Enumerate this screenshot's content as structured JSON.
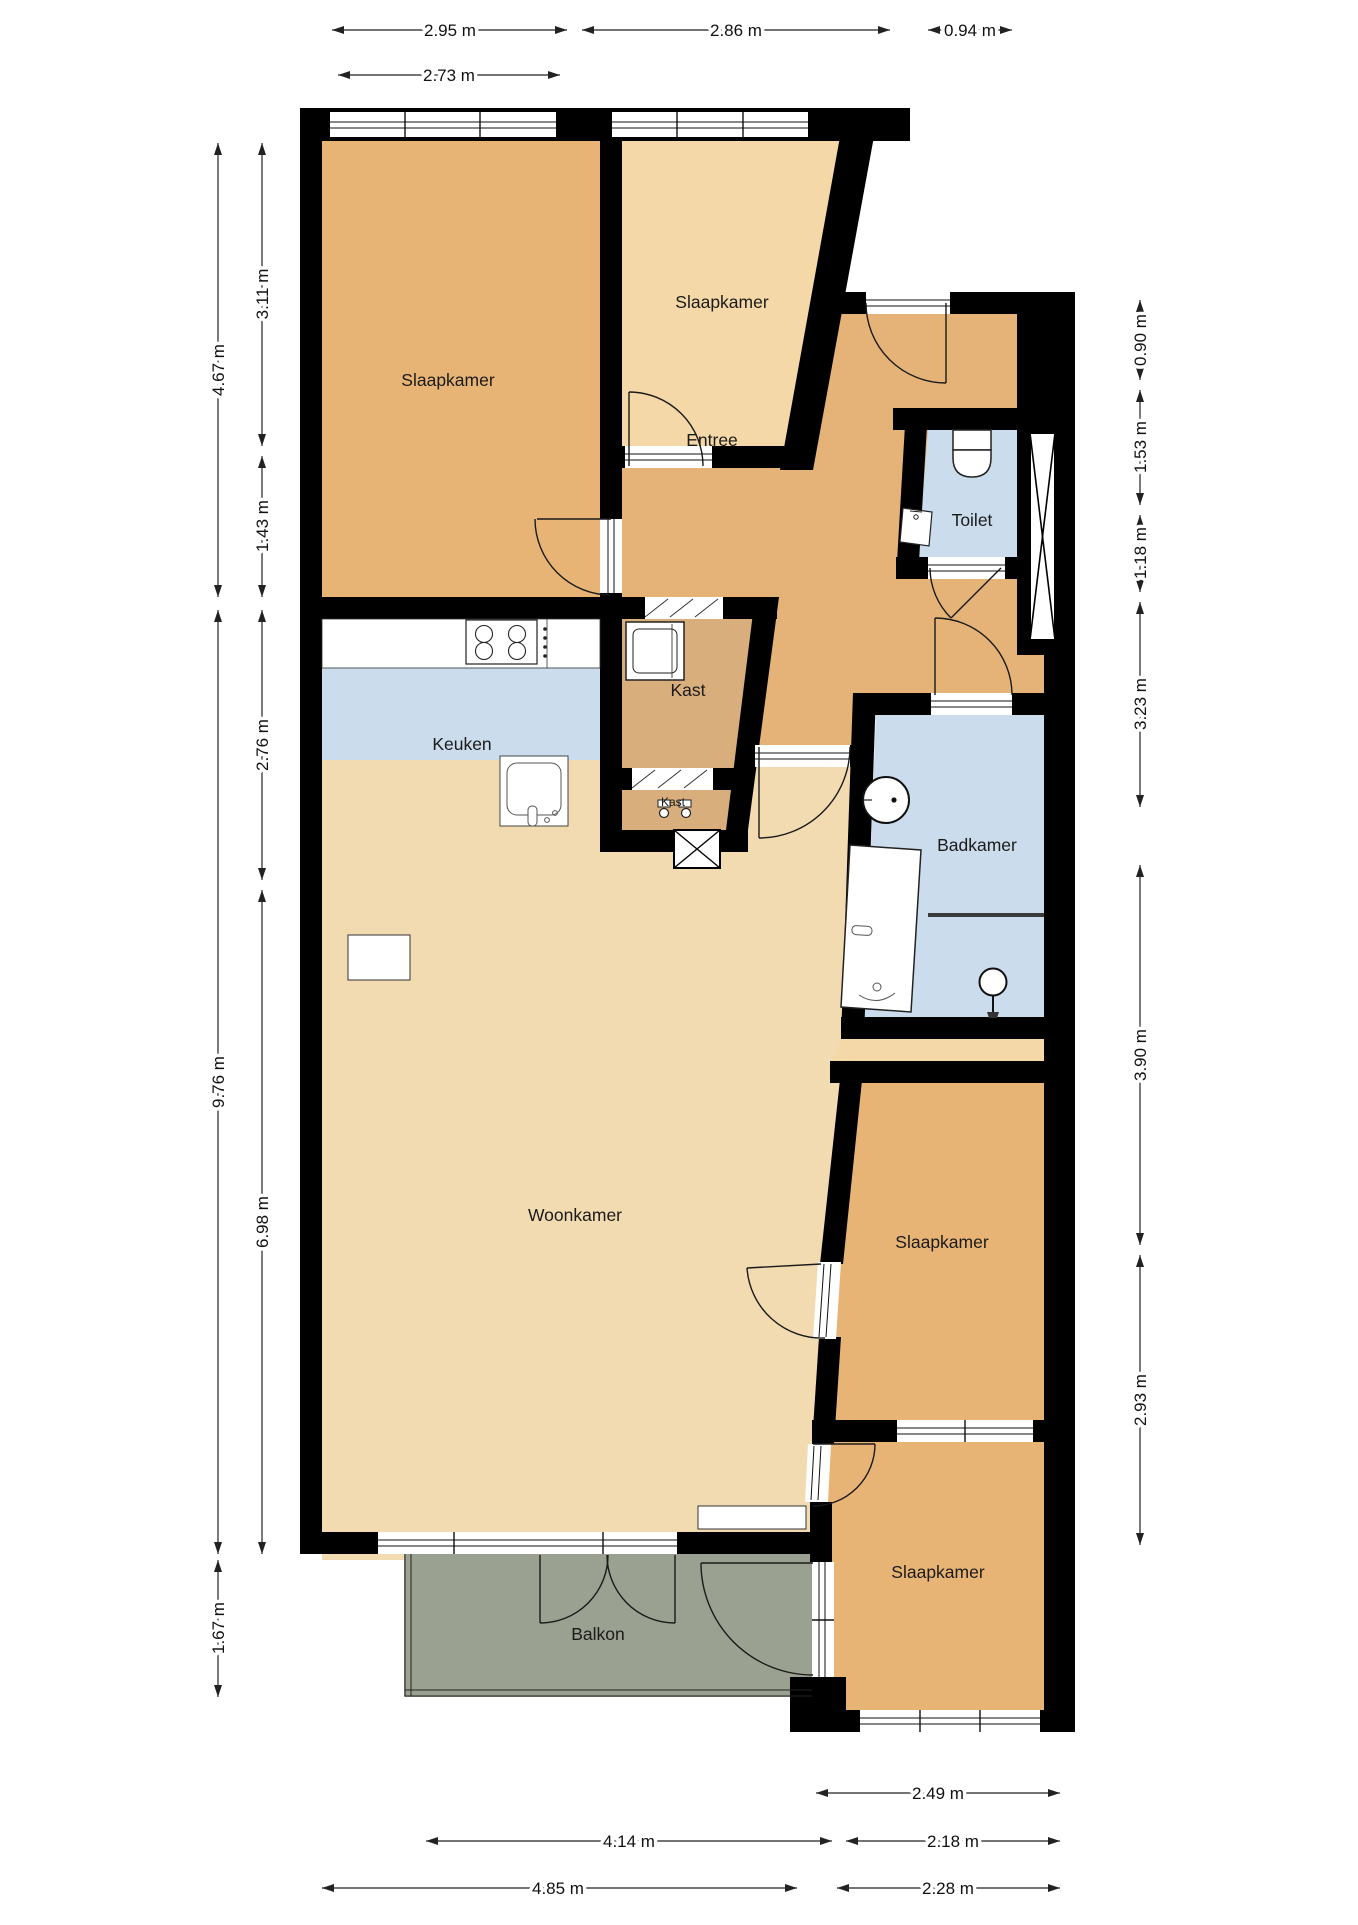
{
  "rooms": {
    "slaapkamer_tl": "Slaapkamer",
    "slaapkamer_tm": "Slaapkamer",
    "entree": "Entree",
    "toilet": "Toilet",
    "kast": "Kast",
    "kast_meter": "Kast",
    "keuken": "Keuken",
    "badkamer": "Badkamer",
    "woonkamer": "Woonkamer",
    "slaapkamer_mr": "Slaapkamer",
    "slaapkamer_br": "Slaapkamer",
    "balkon": "Balkon"
  },
  "dims": {
    "top1": [
      "2.95 m",
      "2.86 m",
      "0.94 m"
    ],
    "top2": [
      "2.73 m"
    ],
    "left_outer": [
      "4.67 m",
      "9.76 m",
      "1.67 m"
    ],
    "left_inner": [
      "3.11 m",
      "1.43 m",
      "2.76 m",
      "6.98 m"
    ],
    "right": [
      "0.90 m",
      "1.53 m",
      "1.18 m",
      "3.23 m",
      "3.90 m",
      "2.93 m"
    ],
    "bottom1": [
      "2.49 m"
    ],
    "bottom2": [
      "4.14 m",
      "2.18 m"
    ],
    "bottom3": [
      "4.85 m",
      "2.28 m"
    ]
  },
  "colors": {
    "wall": "#000000",
    "room_dark": "#e8b476",
    "room_pale": "#f4d8a7",
    "entree": "#e5b377",
    "woonkamer": "#f2dbb1",
    "kast": "#d9ae7d",
    "wet": "#cbdcec",
    "balkon": "#9aa190"
  }
}
